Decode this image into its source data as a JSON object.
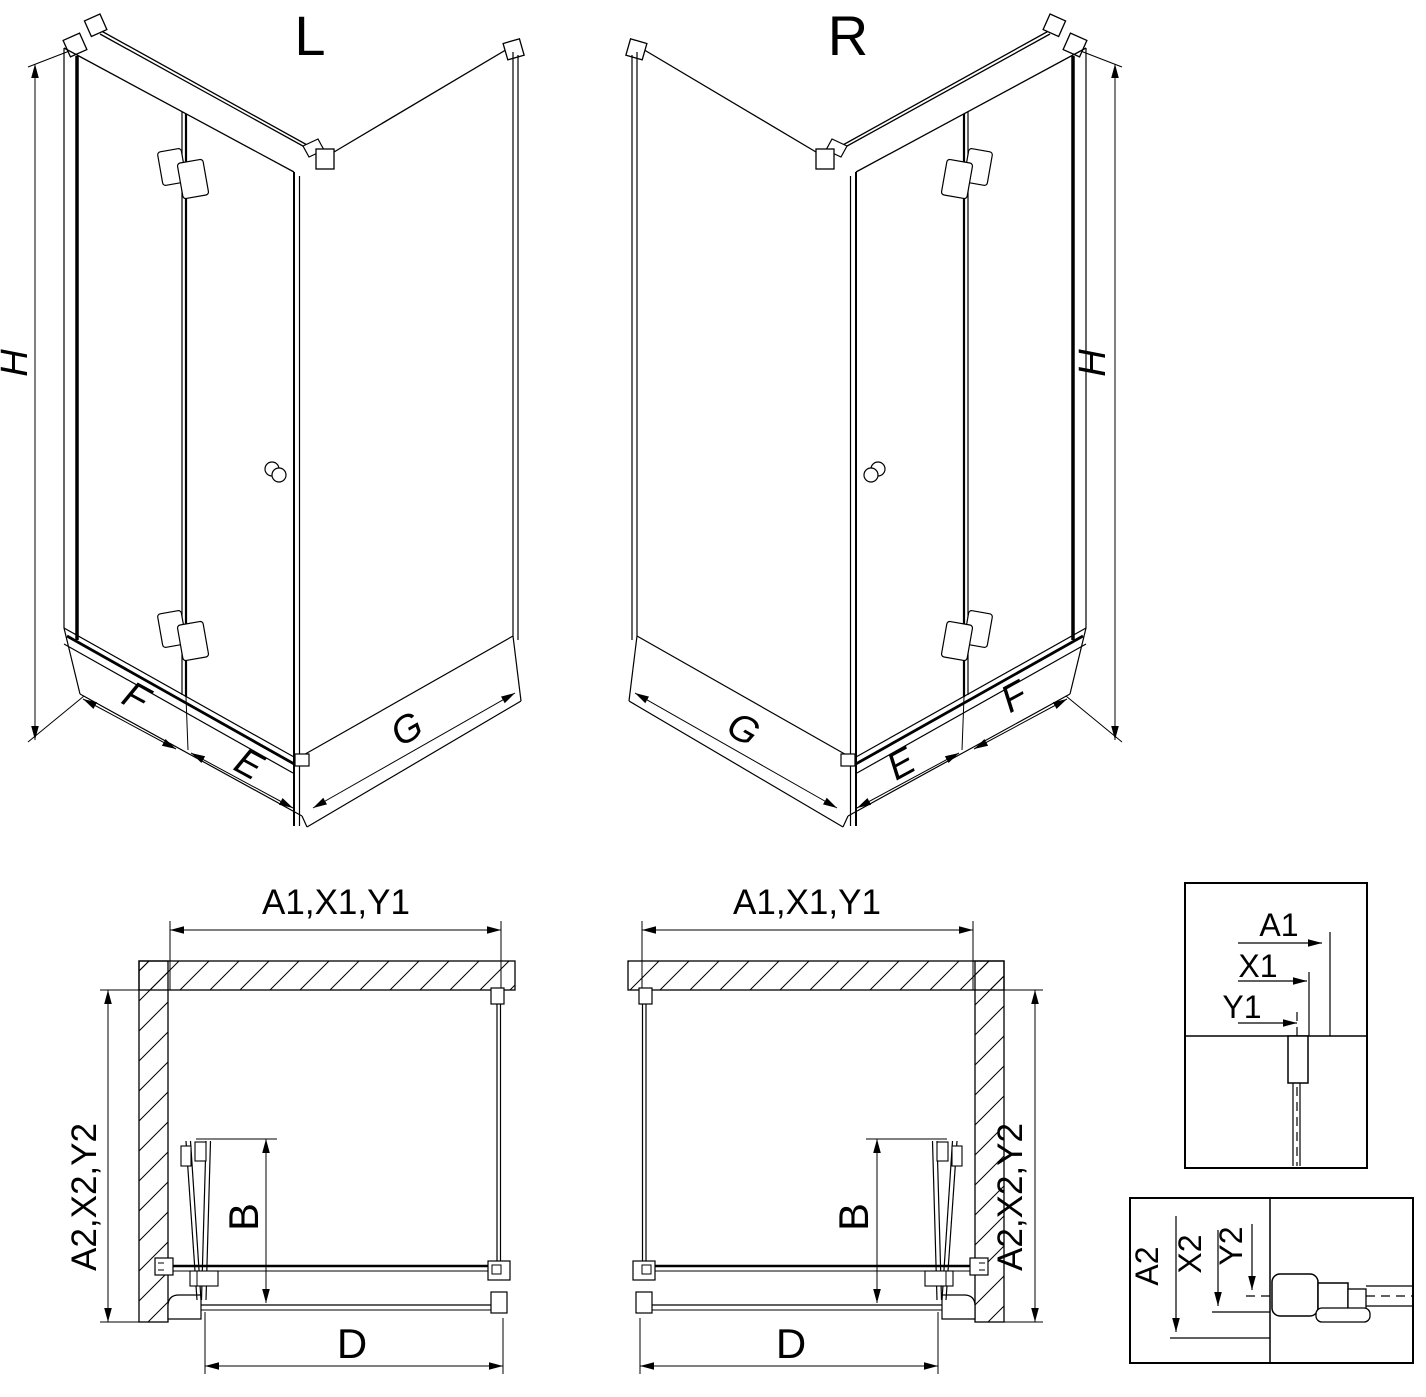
{
  "colors": {
    "line": "#000000",
    "background": "#ffffff"
  },
  "iso_views": {
    "left": {
      "variant": "L",
      "height": "H",
      "fixed_width": "F",
      "door_width": "E",
      "return_width": "G"
    },
    "right": {
      "variant": "R",
      "height": "H",
      "fixed_width": "F",
      "door_width": "E",
      "return_width": "G"
    }
  },
  "plan_views": {
    "left": {
      "top_dim": "A1,X1,Y1",
      "side_dim": "A2,X2,Y2",
      "door_dim": "B",
      "front_dim": "D"
    },
    "right": {
      "top_dim": "A1,X1,Y1",
      "side_dim": "A2,X2,Y2",
      "door_dim": "B",
      "front_dim": "D"
    }
  },
  "details": {
    "top_box": {
      "wall_offset": "A1",
      "profile_offset": "X1",
      "glass_offset": "Y1"
    },
    "bottom_box": {
      "wall_offset": "A2",
      "profile_offset": "X2",
      "glass_offset": "Y2"
    }
  }
}
